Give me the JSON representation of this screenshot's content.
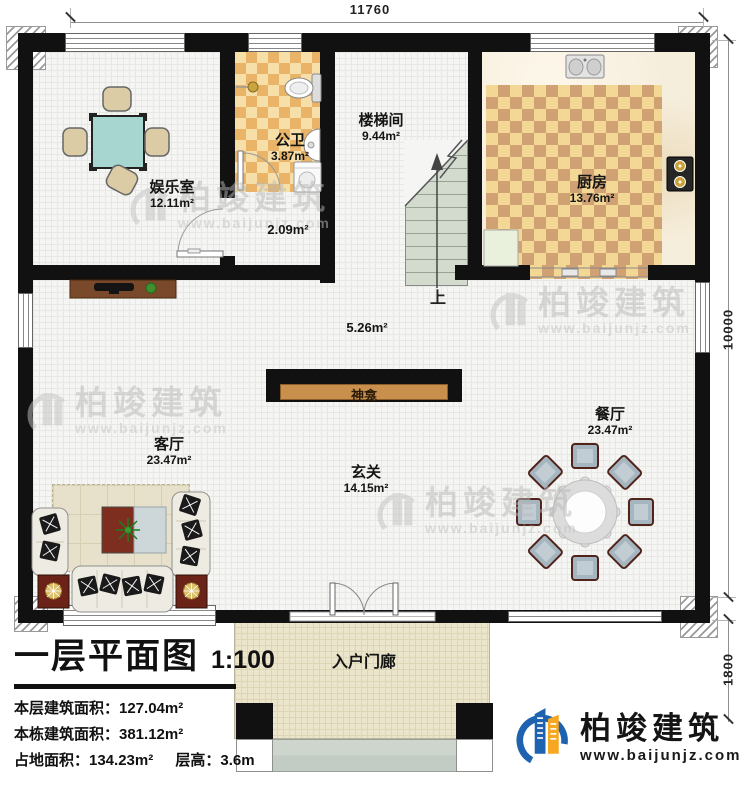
{
  "dimensions": {
    "top": "11760",
    "right": "10000",
    "porch_depth": "1800"
  },
  "rooms": {
    "entertainment": {
      "name": "娱乐室",
      "area": "12.11m²"
    },
    "bathroom": {
      "name": "公卫",
      "area": "3.87m²"
    },
    "vestibule": {
      "name": "",
      "area": "2.09m²"
    },
    "stairwell": {
      "name": "楼梯间",
      "area": "9.44m²"
    },
    "kitchen": {
      "name": "厨房",
      "area": "13.76m²"
    },
    "corridor": {
      "name": "",
      "area": "5.26m²"
    },
    "living": {
      "name": "客厅",
      "area": "23.47m²"
    },
    "dining": {
      "name": "餐厅",
      "area": "23.47m²"
    },
    "foyer": {
      "name": "玄关",
      "area": "14.15m²"
    },
    "porch": {
      "name": "入户门廊",
      "area": ""
    }
  },
  "labels": {
    "up": "上",
    "shrine": "神龛"
  },
  "title_block": {
    "title": "一层平面图",
    "scale": "1:100",
    "stats": [
      "本层建筑面积：127.04m²",
      "本栋建筑面积：381.12m²",
      "占地面积：134.23m²",
      "层高：3.6m"
    ]
  },
  "branding": {
    "company": "柏竣建筑",
    "website": "www.baijunjz.com"
  },
  "colors": {
    "wall": "#111111",
    "tile_light": "#f3d895",
    "tile_dark": "#cfa173",
    "shrine_wood": "#c98f4d",
    "brand_blue": "#1e62b0",
    "brand_orange": "#f7a823"
  }
}
